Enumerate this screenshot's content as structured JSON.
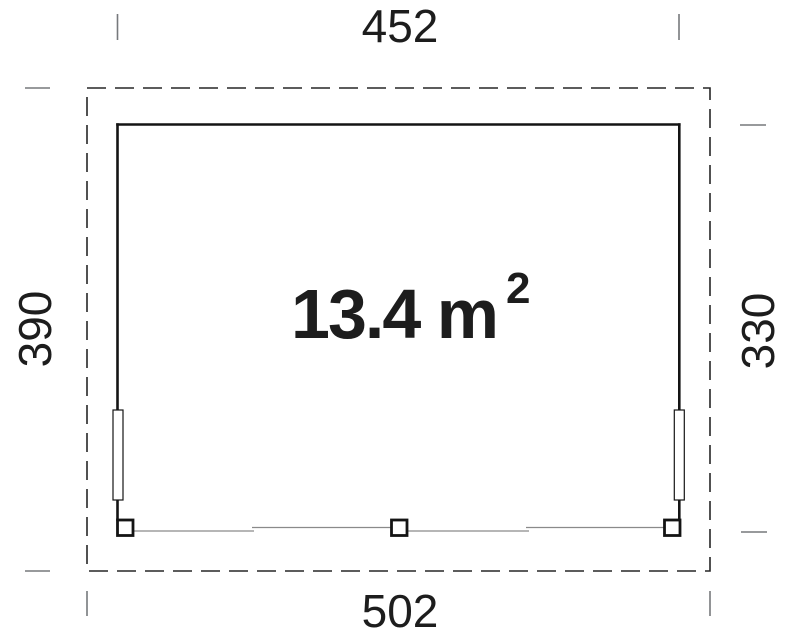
{
  "plan": {
    "area": {
      "label": "13.4 m",
      "superscript": "2"
    },
    "dimensions": {
      "top": "452",
      "bottom": "502",
      "left": "390",
      "right": "330"
    },
    "colors": {
      "wall": "#141414",
      "dashed_boundary": "#262626",
      "tick": "#76797c",
      "beam": "#8a8a8a",
      "label": "#1d1d1d",
      "fill_white": "#ffffff"
    }
  }
}
